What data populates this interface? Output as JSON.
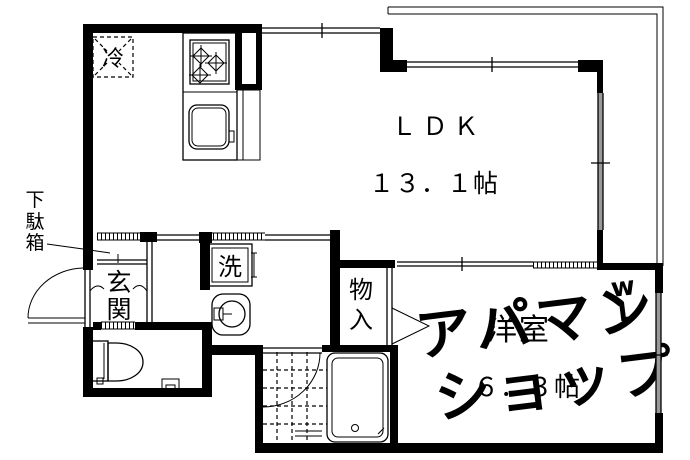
{
  "document": {
    "type": "apartment-floor-plan",
    "background": "#ffffff"
  },
  "colors": {
    "line": "#000000",
    "watermark": "#e3e3e3",
    "window_glass": "#999999"
  },
  "labels": {
    "ldk": "ＬＤＫ",
    "ldk_size": "１３．１帖",
    "western_room": "洋室",
    "western_room_size": "６．３帖",
    "refrigerator": "冷",
    "washer": "洗",
    "entrance": [
      "玄",
      "関"
    ],
    "storage": [
      "物",
      "入"
    ],
    "shoe_cabinet": [
      "下",
      "駄",
      "箱"
    ],
    "watermark": {
      "line1": "アパマン",
      "line2": "ショップ",
      "mark1": "w",
      "mark2": "L"
    }
  }
}
